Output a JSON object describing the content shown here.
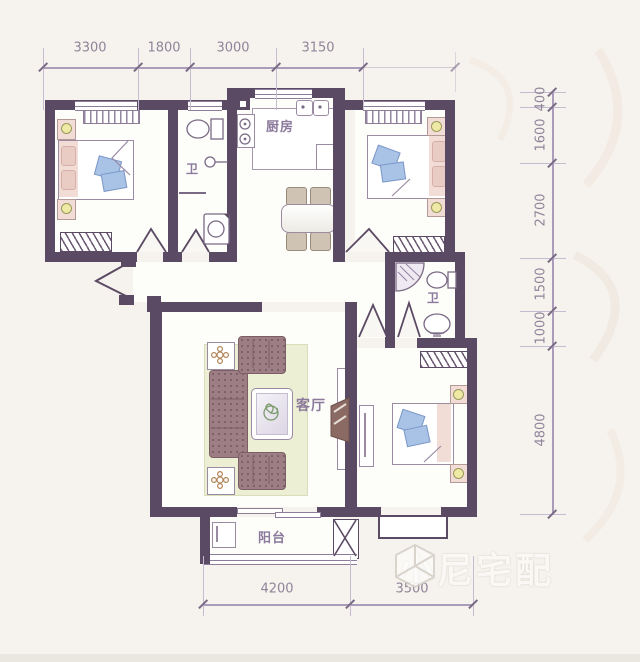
{
  "dimensions": {
    "top": [
      "3300",
      "1800",
      "3000",
      "3150"
    ],
    "right": [
      "400",
      "1600",
      "2700",
      "1500",
      "1000",
      "4800"
    ],
    "bottom": [
      "4200",
      "3500"
    ]
  },
  "rooms": {
    "kitchen": "厨房",
    "bath_upper": "卫",
    "bath_lower": "卫",
    "living": "客厅",
    "balcony": "阳台"
  },
  "watermark": {
    "text": "小尼宅配"
  },
  "colors": {
    "paper": "#f6f3ee",
    "floor": "#fdfdfa",
    "wall": "#5b4a63",
    "wallLight": "#8e7d99",
    "dimLine": "#a99dbb",
    "dimText": "#8f8599",
    "label": "#8b7a9b",
    "bedPink": "#f2ddd6",
    "pillowBlue": "#a9c3e6",
    "sofa": "#9d7e84",
    "rug": "#ecefd4",
    "lamp": "#efe9a6",
    "chair": "#cfc3b4",
    "tv": "#8a6a62"
  }
}
